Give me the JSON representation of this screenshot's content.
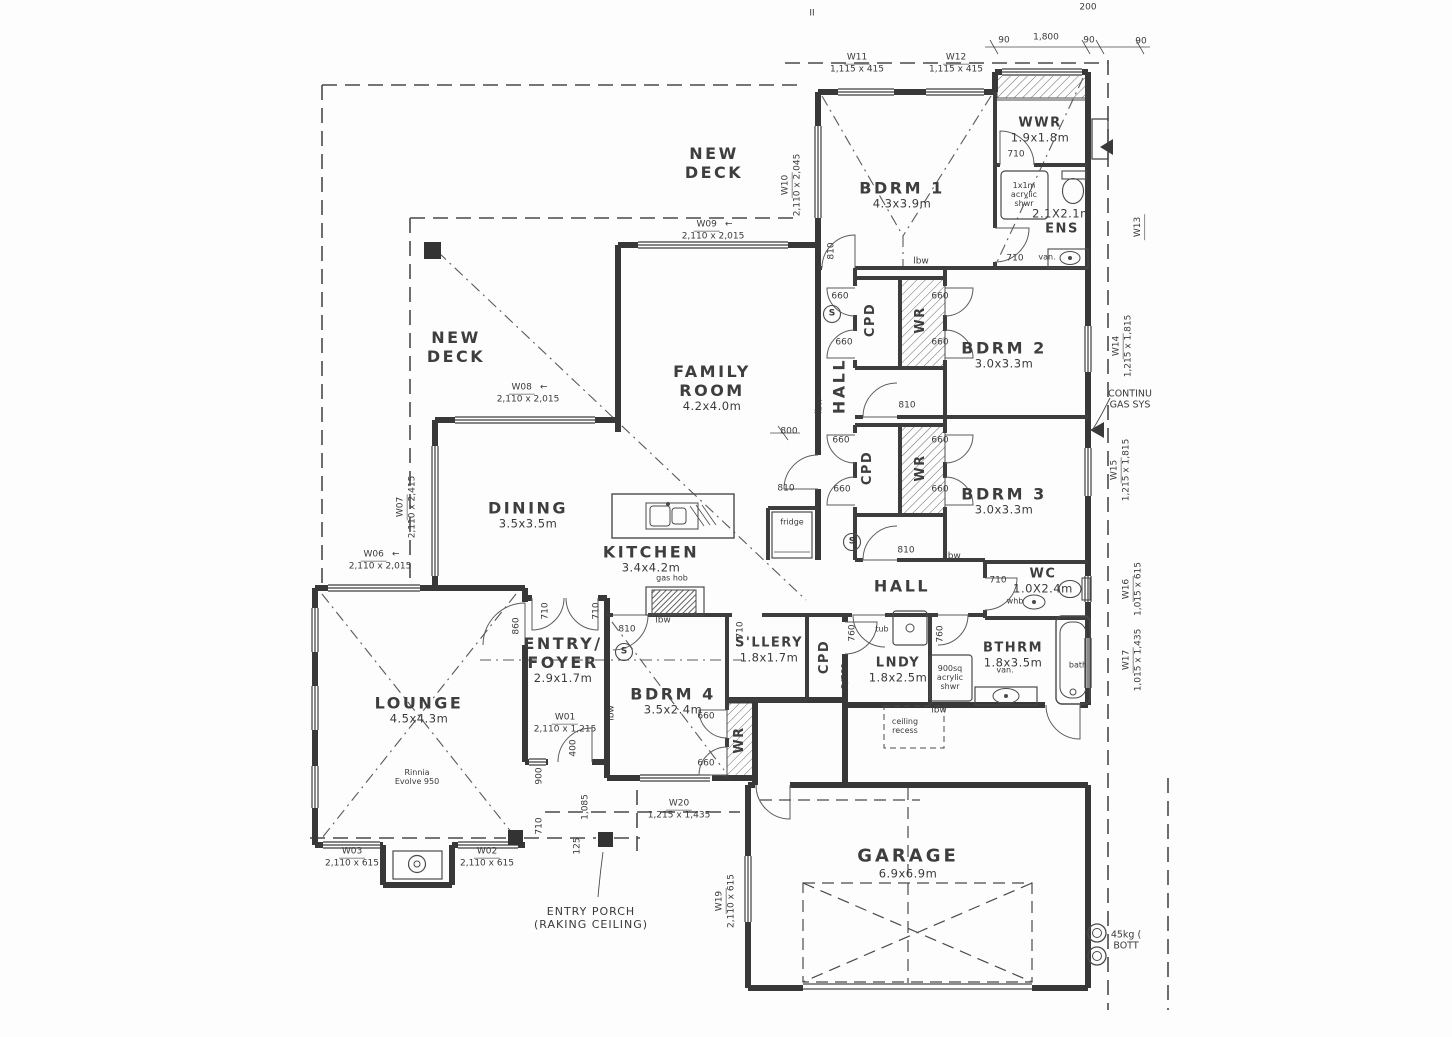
{
  "plan": {
    "rooms": {
      "new_deck_top": {
        "line1": "NEW",
        "line2": "DECK"
      },
      "new_deck_left": {
        "line1": "NEW",
        "line2": "DECK"
      },
      "bdrm1": {
        "name": "BDRM 1",
        "size": "4.3x3.9m"
      },
      "wwr": {
        "name": "WWR",
        "size": "1.9x1.8m"
      },
      "ens": {
        "name": "ENS",
        "size": "2.1X2.1m"
      },
      "bdrm2": {
        "name": "BDRM 2",
        "size": "3.0x3.3m"
      },
      "bdrm3": {
        "name": "BDRM 3",
        "size": "3.0x3.3m"
      },
      "family_room": {
        "line1": "FAMILY",
        "line2": "ROOM",
        "size": "4.2x4.0m"
      },
      "dining": {
        "name": "DINING",
        "size": "3.5x3.5m"
      },
      "kitchen": {
        "name": "KITCHEN",
        "size": "3.4x4.2m"
      },
      "hall_upper": {
        "name": "HALL"
      },
      "hall_lower": {
        "name": "HALL"
      },
      "entry_foyer": {
        "line1": "ENTRY/",
        "line2": "FOYER",
        "size": "2.9x1.7m"
      },
      "lounge": {
        "name": "LOUNGE",
        "size": "4.5x4.3m"
      },
      "bdrm4": {
        "name": "BDRM 4",
        "size": "3.5x2.4m"
      },
      "sllery": {
        "name": "S'LLERY",
        "size": "1.8x1.7m"
      },
      "lndy": {
        "name": "LNDY",
        "size": "1.8x2.5m"
      },
      "bthrm": {
        "name": "BTHRM",
        "size": "1.8x3.5m"
      },
      "wc": {
        "name": "WC",
        "size": "1.0X2.4m"
      },
      "garage": {
        "name": "GARAGE",
        "size": "6.9x6.9m"
      },
      "entry_porch": {
        "line1": "ENTRY PORCH",
        "line2": "(RAKING CEILING)"
      }
    },
    "closets": {
      "cpd": "CPD",
      "wr": "WR"
    },
    "windows": {
      "w01": {
        "id": "W01",
        "size": "2,110 x 1,215"
      },
      "w02": {
        "id": "W02",
        "size": "2,110 x 615"
      },
      "w03": {
        "id": "W03",
        "size": "2,110 x 615"
      },
      "w06": {
        "id": "W06",
        "size": "2,110 x 2,015"
      },
      "w07": {
        "id": "W07",
        "size": "2,110 x 2,415"
      },
      "w08": {
        "id": "W08",
        "size": "2,110 x 2,015"
      },
      "w09": {
        "id": "W09",
        "size": "2,110 x 2,015"
      },
      "w10": {
        "id": "W10",
        "size": "2,110 x 2,045"
      },
      "w11": {
        "id": "W11",
        "size": "1,115 x 415"
      },
      "w12": {
        "id": "W12",
        "size": "1,115 x 415"
      },
      "w13": {
        "id": "W13",
        "size": ""
      },
      "w14": {
        "id": "W14",
        "size": "1,215 x 1,815"
      },
      "w15": {
        "id": "W15",
        "size": "1,215 x 1,815"
      },
      "w16": {
        "id": "W16",
        "size": "1,015 x 615"
      },
      "w17": {
        "id": "W17",
        "size": "1,015 x 1,435"
      },
      "w19": {
        "id": "W19",
        "size": "2,110 x 615"
      },
      "w20": {
        "id": "W20",
        "size": "1,215 x 1,435"
      }
    },
    "dims": {
      "d90": "90",
      "d200": "200",
      "d1800": "1,800",
      "d800": "800",
      "d810": "810",
      "d710": "710",
      "d660": "660",
      "d760": "760",
      "d2_760": "2/760",
      "d860": "860",
      "d900": "900",
      "d400": "400",
      "d125": "125",
      "d1085": "1,085",
      "arrow": "←"
    },
    "fixtures": {
      "fridge": "fridge",
      "gas_hob": "gas hob",
      "tub": "tub",
      "whb": "whb",
      "van": "van.",
      "bath": "bath",
      "shwr_1x1": {
        "l1": "1x1m",
        "l2": "acrylic",
        "l3": "shwr"
      },
      "shwr_900": {
        "l1": "900sq",
        "l2": "acrylic",
        "l3": "shwr"
      },
      "fireplace": {
        "l1": "Rinnia",
        "l2": "Evolve 950"
      },
      "ceiling_recess": {
        "l1": "ceiling",
        "l2": "recess"
      },
      "smoke": "S"
    },
    "notes": {
      "lbw": "lbw",
      "gas_l1": "CONTINU",
      "gas_l2": "GAS SYS",
      "bottle_l1": "45kg (",
      "bottle_l2": "BOTT",
      "tick": "II"
    }
  }
}
